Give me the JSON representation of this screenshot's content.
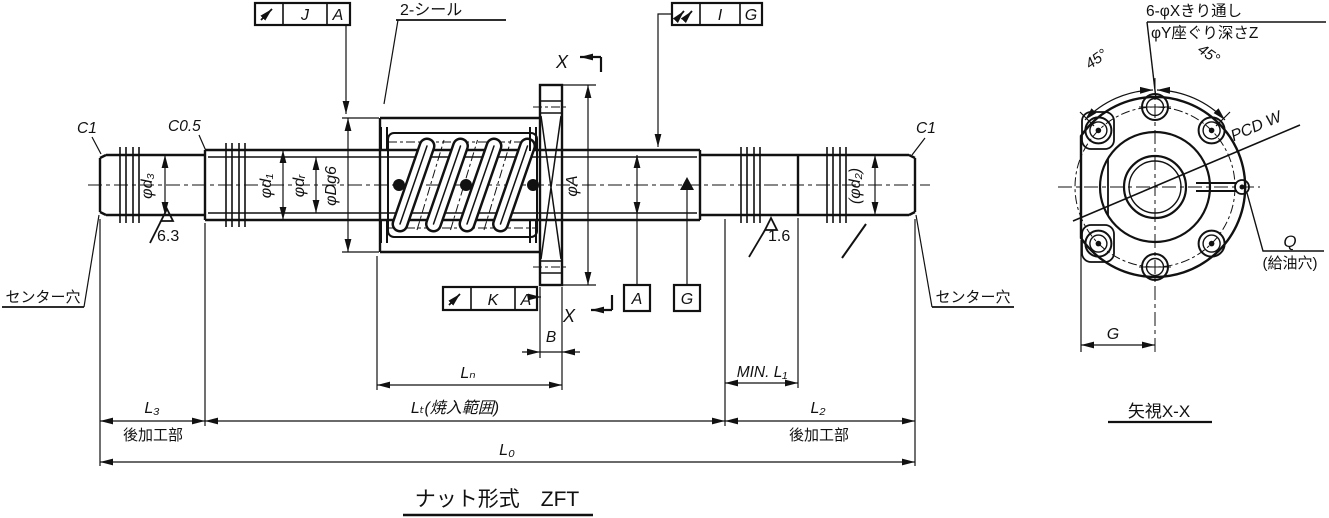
{
  "drawing": {
    "title": "ナット形式　ZFT",
    "section_view_label": "矢視X-X",
    "section_letter": "X"
  },
  "tolerance_frames": {
    "nut_od": {
      "symbol": "circular-runout",
      "tolerance": "J",
      "datum": "A"
    },
    "shaft_journal": {
      "symbol": "total-runout",
      "tolerance": "I",
      "datum": "G"
    },
    "flange_face": {
      "symbol": "circular-runout",
      "tolerance": "K",
      "datum": "A"
    }
  },
  "datums": {
    "a": "A",
    "g": "G"
  },
  "callouts": {
    "seals": "2-シール",
    "bolt_holes": "6-φXきり通し",
    "counterbore": "φY座ぐり深さZ",
    "center_hole_left": "センター穴",
    "center_hole_right": "センター穴",
    "oil_hole_letter": "Q",
    "oil_hole_note": "(給油穴)",
    "pcd": "PCD W",
    "angle_left": "45°",
    "angle_right": "45°",
    "chamfer_left": "C1",
    "chamfer_step": "C0.5",
    "chamfer_right": "C1",
    "finish_rough": "6.3",
    "finish_fine": "1.6"
  },
  "diameters": {
    "d3": "φd₃",
    "d1": "φd₁",
    "dr": "φdᵣ",
    "D": "φDg6",
    "A": "φA",
    "d2": "(φd₂)"
  },
  "lengths": {
    "B": "B",
    "Ln": "Lₙ",
    "Lt": "Lₜ(焼入範囲)",
    "min_L1": "MIN. L₁",
    "L3": "L₃",
    "L2": "L₂",
    "L0": "L₀",
    "G": "G"
  },
  "notes": {
    "post_machined_left": "後加工部",
    "post_machined_right": "後加工部"
  }
}
